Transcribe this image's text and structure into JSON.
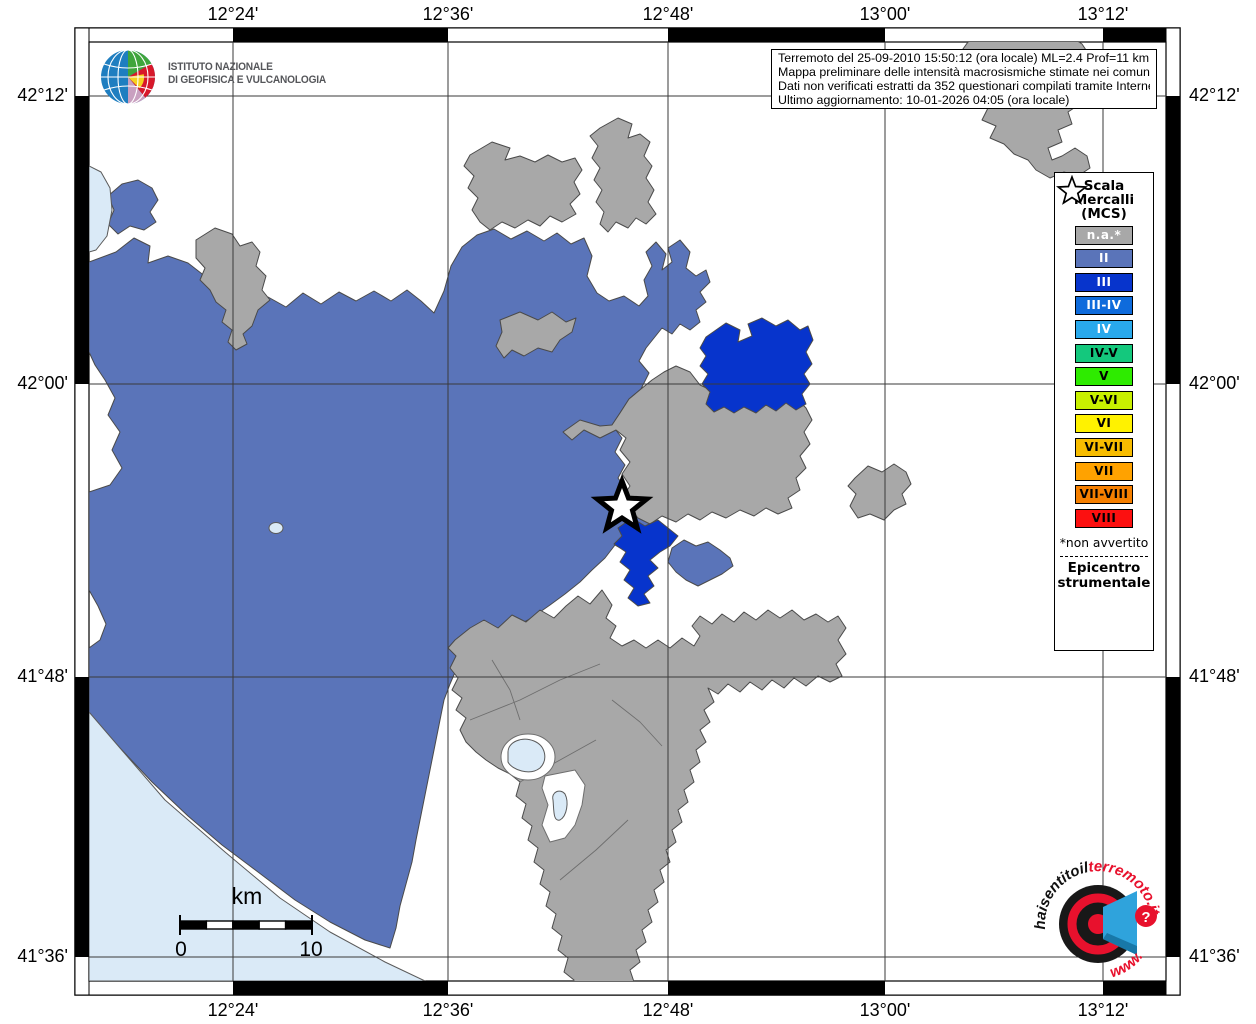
{
  "header": {
    "info_box_lines": [
      "Terremoto del 25-09-2010 15:50:12 (ora locale) ML=2.4 Prof=11 km",
      "Mappa preliminare delle intensità macrosismiche stimate nei comuni",
      "Dati non verificati estratti da 352 questionari compilati tramite Internet.",
      "Ultimo aggiornamento: 10-01-2026 04:05 (ora locale)"
    ]
  },
  "logos": {
    "ingv_line1": "ISTITUTO NAZIONALE",
    "ingv_line2": "DI GEOFISICA E VULCANOLOGIA",
    "hsit_arc_black": "haisentitoil",
    "hsit_arc_red": "terremoto.it",
    "hsit_bottom": "www.",
    "hsit_question": "?"
  },
  "axes": {
    "top": [
      "12°24'",
      "12°36'",
      "12°48'",
      "13°00'",
      "13°12'"
    ],
    "bottom": [
      "12°24'",
      "12°36'",
      "12°48'",
      "13°00'",
      "13°12'"
    ],
    "left": [
      "42°12'",
      "42°00'",
      "41°48'",
      "41°36'"
    ],
    "right": [
      "42°12'",
      "42°00'",
      "41°48'",
      "41°36'"
    ]
  },
  "scalebar": {
    "unit": "km",
    "start": "0",
    "end": "10"
  },
  "legend": {
    "title_lines": [
      "Scala",
      "Mercalli",
      "(MCS)"
    ],
    "items": [
      {
        "label": "n.a.*",
        "color": "#A8A8A8",
        "text_color": "#FFFFFF"
      },
      {
        "label": "II",
        "color": "#5A74B9",
        "text_color": "#FFFFFF"
      },
      {
        "label": "III",
        "color": "#0734CC",
        "text_color": "#FFFFFF"
      },
      {
        "label": "III-IV",
        "color": "#0E6BDC",
        "text_color": "#FFFFFF"
      },
      {
        "label": "IV",
        "color": "#29A9EC",
        "text_color": "#FFFFFF"
      },
      {
        "label": "IV-V",
        "color": "#14C87D",
        "text_color": "#000000"
      },
      {
        "label": "V",
        "color": "#2EEB00",
        "text_color": "#000000"
      },
      {
        "label": "V-VI",
        "color": "#C8F000",
        "text_color": "#000000"
      },
      {
        "label": "VI",
        "color": "#FFF200",
        "text_color": "#000000"
      },
      {
        "label": "VI-VII",
        "color": "#F7BC00",
        "text_color": "#000000"
      },
      {
        "label": "VII",
        "color": "#FFA200",
        "text_color": "#000000"
      },
      {
        "label": "VII-VIII",
        "color": "#F57F00",
        "text_color": "#000000"
      },
      {
        "label": "VIII",
        "color": "#FC1010",
        "text_color": "#000000"
      }
    ],
    "footnote": "*non avvertito",
    "epicenter_lines": [
      "Epicentro",
      "strumentale"
    ]
  },
  "map_colors": {
    "na": "#A8A8A8",
    "ii": "#5A74B9",
    "iii": "#0734CC",
    "water": "#DAEAF7",
    "border": "#4a4a4a"
  }
}
